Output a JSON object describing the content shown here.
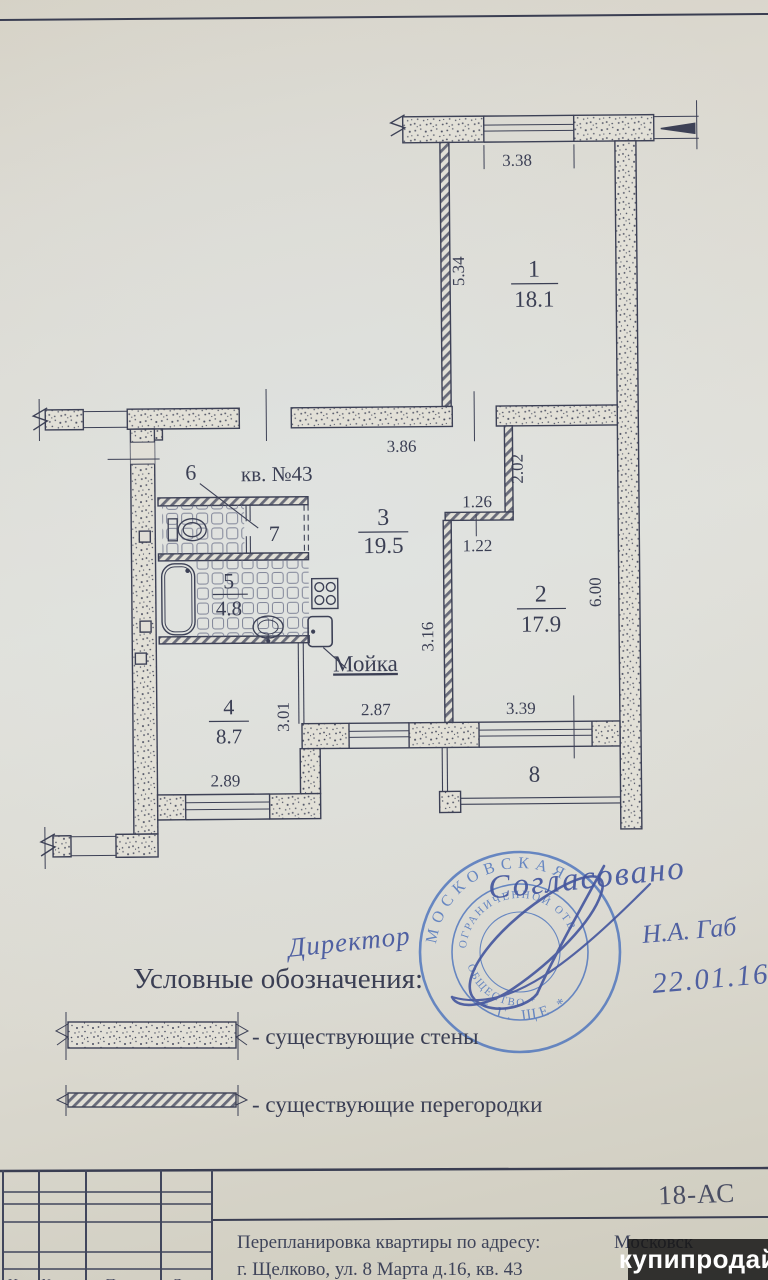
{
  "document": {
    "watermark": "купипродай"
  },
  "plan": {
    "apartment_label": "кв. №43",
    "sink_label": "Мойка",
    "rooms": [
      {
        "number": "1",
        "area": "18.1"
      },
      {
        "number": "2",
        "area": "17.9"
      },
      {
        "number": "3",
        "area": "19.5"
      },
      {
        "number": "4",
        "area": "8.7"
      },
      {
        "number": "5",
        "area": "4.8"
      },
      {
        "number": "6",
        "area": ""
      },
      {
        "number": "7",
        "area": ""
      },
      {
        "number": "8",
        "area": ""
      }
    ],
    "dimensions": {
      "top_window": "3.38",
      "room1_height": "5.34",
      "hall_width": "3.86",
      "niche_depth": "2.02",
      "niche_width": "1.26",
      "niche_offset": "1.22",
      "room2_height": "6.00",
      "kitchen_depth": "3.16",
      "room4_depth": "3.01",
      "kitchen_window": "2.87",
      "room2_window": "3.39",
      "room4_window": "2.89"
    }
  },
  "legend": {
    "title": "Условные обозначения:",
    "items": [
      {
        "label": "- существующие стены"
      },
      {
        "label": "- существующие перегородки"
      }
    ]
  },
  "approval": {
    "agreed": "Согласовано",
    "title": "Директор",
    "name": "Н.А. Габ",
    "date": "22.01.16",
    "stamp": {
      "arc_outer_top": "МОСКОВСКАЯ",
      "arc_inner_top": "ОГРАНИЧЕННОЙ ОТВ",
      "arc_inner_bottom": "ОБЩЕСТВО *",
      "arc_outer_bottom": "* Г. ЩЕ *"
    }
  },
  "title_block": {
    "code": "18-АС",
    "subject": "Перепланировка квартиры по адресу:",
    "region": "Московск",
    "address": "г. Щелково, ул. 8 Марта д.16, кв. 43",
    "footer_columns": [
      "Изм",
      "№ док.",
      "Подп.",
      "Дата"
    ]
  }
}
